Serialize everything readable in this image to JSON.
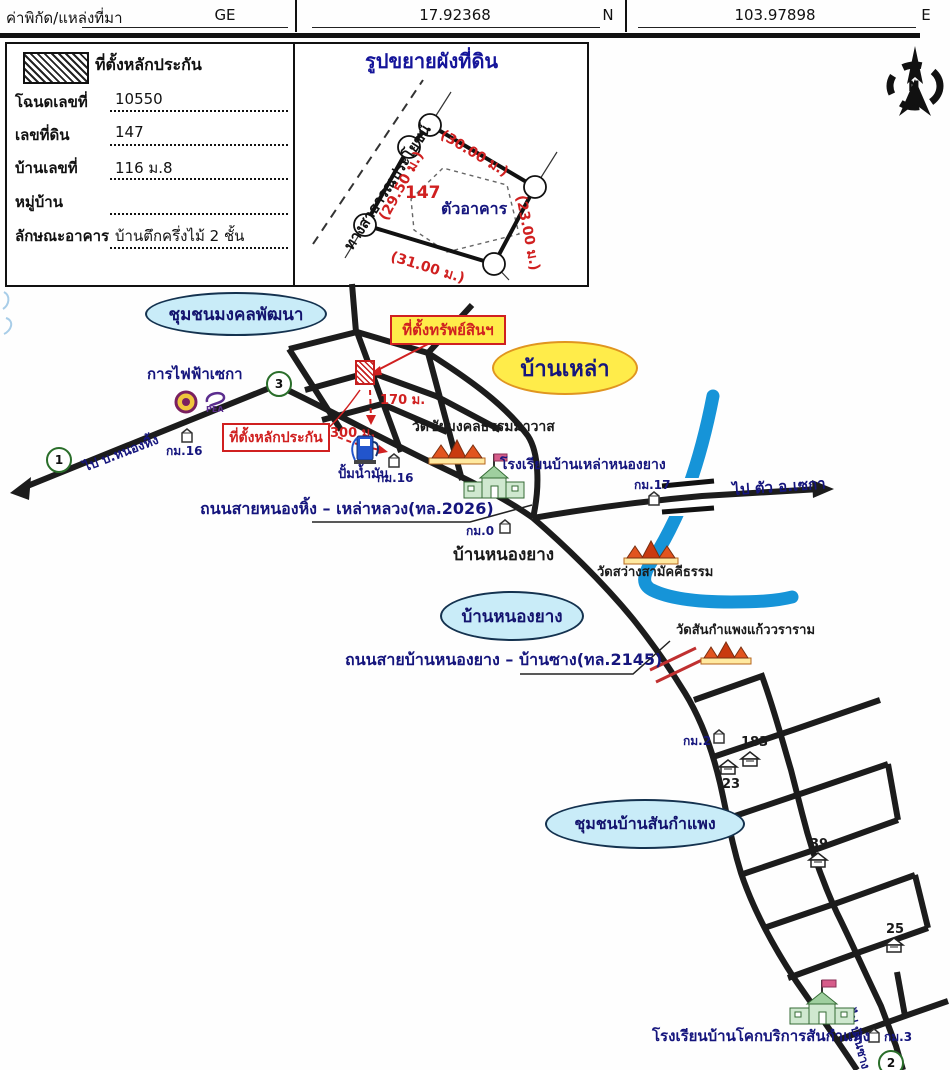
{
  "header": {
    "label": "ค่าพิกัด/แหล่งที่มา",
    "source": "GE",
    "lat": "17.92368",
    "lat_dir": "N",
    "lon": "103.97898",
    "lon_dir": "E"
  },
  "form": {
    "legend": "ที่ตั้งหลักประกัน",
    "fields": [
      {
        "label": "โฉนดเลขที่",
        "value": "10550"
      },
      {
        "label": "เลขที่ดิน",
        "value": "147"
      },
      {
        "label": "บ้านเลขที่",
        "value": "116 ม.8"
      },
      {
        "label": "หมู่บ้าน",
        "value": ""
      },
      {
        "label": "ลักษณะอาคาร",
        "value": "บ้านตึกครึ่งไม้ 2 ชั้น"
      }
    ]
  },
  "plot": {
    "title": "รูปขยายผังที่ดิน",
    "road": "ทางสาธารณประโยชน์",
    "parcel_no": "147",
    "building": "ตัวอาคาร",
    "dim_top": "(30.00 ม.)",
    "dim_left": "(29.50 ม.)",
    "dim_right": "(23.00 ม.)",
    "dim_bottom": "(31.00 ม.)"
  },
  "compass": {
    "north": "N"
  },
  "map": {
    "ellipses": {
      "mongkol": "ชุมชนมงคลพัฒนา",
      "banlao": "บ้านเหล่า",
      "nongyang": "บ้านหนองยาง",
      "sankamphaeng": "ชุมชนบ้านสันกำแพง"
    },
    "property_tag": "ที่ตั้งทรัพย์สินฯ",
    "collateral_tag": "ที่ตั้งหลักประกัน",
    "dist_170": "170 ม.",
    "dist_300": "300 ม.",
    "electric_authority": "การไฟฟ้าเซกา",
    "pea": "PEA",
    "gas_station": "ปั้มน้ำมัน",
    "temple_1": "วัดชัยมงคลธรรมมาวาส",
    "school_1": "โรงเรียนบ้านเหล่าหนองยาง",
    "village_nongyang": "บ้านหนองยาง",
    "temple_2": "วัดสว่างสามัคคีธรรม",
    "temple_3": "วัดสันกำแพงแก้ววราราม",
    "school_2": "โรงเรียนบ้านโคกบริการสันกำแพง",
    "road_2026": "ถนนสายหนองหิ้ง – เหล่าหลวง(ทล.2026)",
    "road_2145": "ถนนสายบ้านหนองยาง – บ้านซาง(ทล.2145)",
    "dir_west": "ไป บ.หนองหิ้ง",
    "dir_east": "ไป ตัว อ.เซกา",
    "dir_south": "ไป บ้านซาง",
    "km16_a": "กม.16",
    "km16_b": "กม.16",
    "km17": "กม.17",
    "km0": "กม.0",
    "km2": "กม.2",
    "km3": "กม.3",
    "house_183": "183",
    "house_23": "23",
    "house_39": "39",
    "house_25": "25",
    "route_1": "1",
    "route_2": "2",
    "route_3": "3"
  },
  "colors": {
    "navy_text": "#15157d",
    "red_marker": "#d02020",
    "road_black": "#1c1c1c",
    "river_blue": "#1694d8",
    "ellipse_blue": "#c9ecf8",
    "ellipse_yellow": "#ffec4a"
  }
}
